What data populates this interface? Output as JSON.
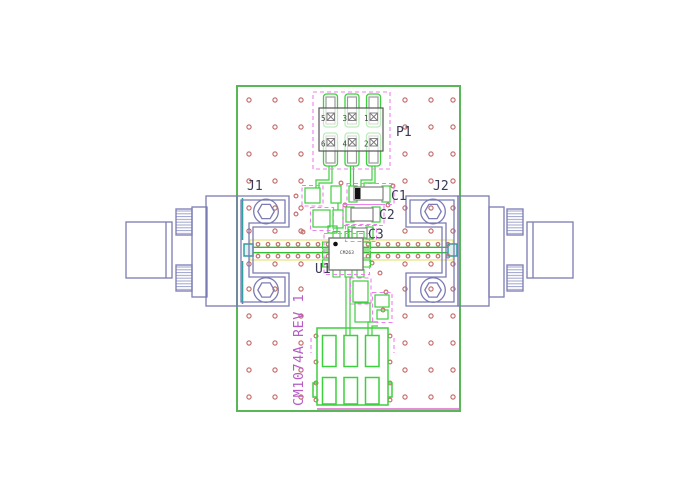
{
  "drawing": {
    "title": "PCB layout drawing",
    "board_text": "CM1074A REV 1",
    "designators": {
      "j1": "J1",
      "j2": "J2",
      "p1": "P1",
      "u1": "U1",
      "c1": "C1",
      "c2": "C2",
      "c3": "C3"
    },
    "u1_part": "CM263",
    "p1_pin_numbers": [
      "5",
      "3",
      "1",
      "6",
      "4",
      "2"
    ],
    "colors": {
      "board_outline": "#58b858",
      "pad_green": "#3ecf3e",
      "via": "#c4706e",
      "courtyard_magenta": "#ee7fee",
      "silk_text": "#3a3a55",
      "board_text_magenta": "#b65cc4",
      "bottom_line_magenta": "#dd66cc",
      "connector_blue": "#7b7bb4",
      "connector_hatch": "#a2a8d0",
      "band_yellow": "#e6e68a",
      "pad_teal": "#2f9f9f",
      "component_gray": "#888888",
      "chip_border": "#777777",
      "cap_bar_black": "#111111"
    }
  }
}
